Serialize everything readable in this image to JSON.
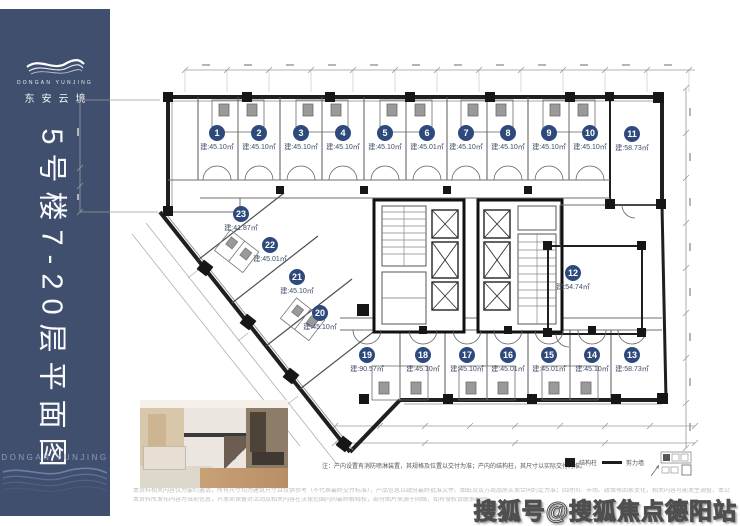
{
  "brand": {
    "name_en": "DONGAN YUNJING",
    "name_cn": "东安云境"
  },
  "sidebar": {
    "title": "5号楼7-20层平面图",
    "footer_en": "DONGAN YUNJING",
    "bg_color": "#414F6E"
  },
  "plan": {
    "accent_color": "#2E4A7C",
    "units": [
      {
        "no": "1",
        "area": "建:45.10㎡"
      },
      {
        "no": "2",
        "area": "建:45.10㎡"
      },
      {
        "no": "3",
        "area": "建:45.10㎡"
      },
      {
        "no": "4",
        "area": "建:45.10㎡"
      },
      {
        "no": "5",
        "area": "建:45.10㎡"
      },
      {
        "no": "6",
        "area": "建:45.01㎡"
      },
      {
        "no": "7",
        "area": "建:45.10㎡"
      },
      {
        "no": "8",
        "area": "建:45.10㎡"
      },
      {
        "no": "9",
        "area": "建:45.10㎡"
      },
      {
        "no": "10",
        "area": "建:45.10㎡"
      },
      {
        "no": "11",
        "area": "建:58.73㎡"
      },
      {
        "no": "12",
        "area": "建:54.74㎡"
      },
      {
        "no": "13",
        "area": "建:58.73㎡"
      },
      {
        "no": "14",
        "area": "建:45.10㎡"
      },
      {
        "no": "15",
        "area": "建:45.01㎡"
      },
      {
        "no": "16",
        "area": "建:45.01㎡"
      },
      {
        "no": "17",
        "area": "建:45.10㎡"
      },
      {
        "no": "18",
        "area": "建:45.10㎡"
      },
      {
        "no": "19",
        "area": "建:90.57㎡"
      },
      {
        "no": "20",
        "area": "建:45.10㎡"
      },
      {
        "no": "21",
        "area": "建:45.10㎡"
      },
      {
        "no": "22",
        "area": "建:45.01㎡"
      },
      {
        "no": "23",
        "area": "建:41.87㎡"
      }
    ],
    "note": "注：产内设置有消防喷淋装置，其规格及位置以交付为准；产内的结构柱，其尺寸以实际交付为准。",
    "legend": {
      "column": "结构柱",
      "wall": "剪力墙"
    }
  },
  "footer": {
    "disclaimer_line1": "本资料相关内容仅为要约邀请，所有尺寸均为建筑尺寸且仅供参考（不代表最终交付标准），产品信息以政府最终批准文件、图纸及双方商品房买卖合同约定为准；因时间、市场、政策等因素变化，相关内容可能发生调整，本公司保留对宣传资料修改的权利，敬请留意最新资料。",
    "disclaimer_line2": "本资料所发布内容为当前信息，开发商保留对活动及相关内容在法律范围内的最终解释权，部分图片来源于网络，如有侵权请联系删除。"
  },
  "watermark": "搜狐号@搜狐焦点德阳站"
}
